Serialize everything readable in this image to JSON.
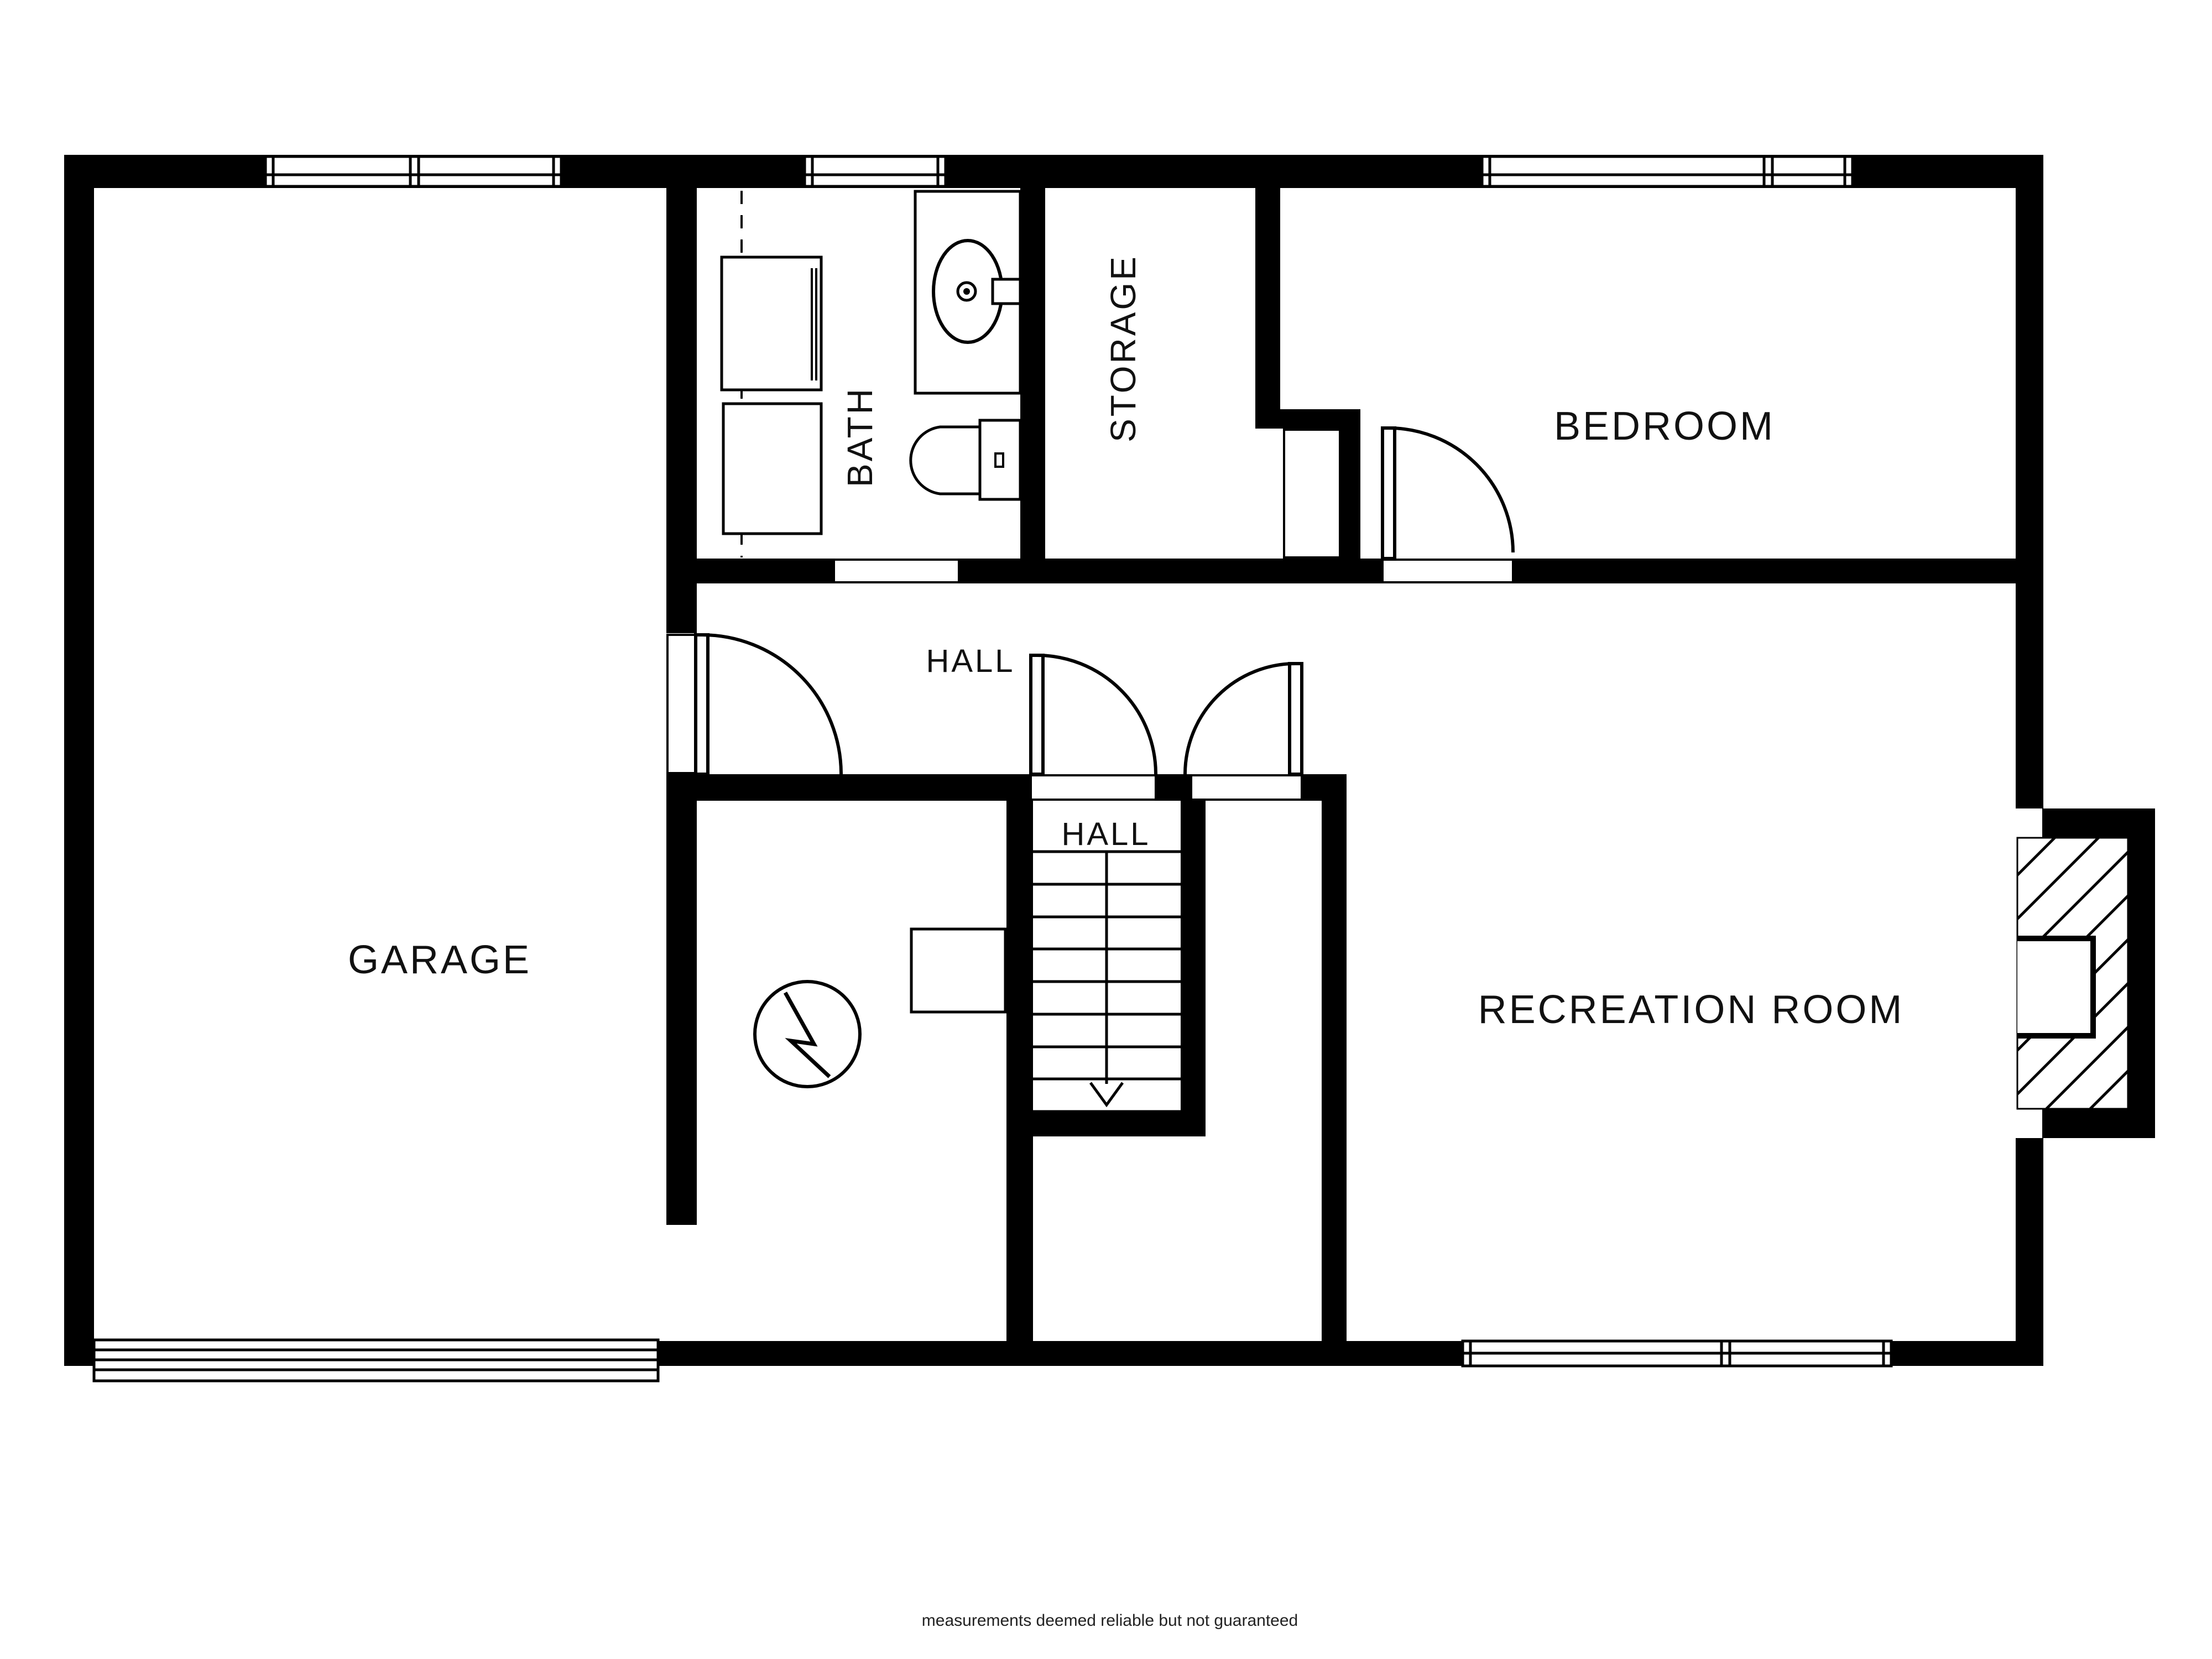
{
  "disclaimer": "measurements deemed reliable but not guaranteed",
  "colors": {
    "wall": "#000000",
    "background": "#ffffff",
    "label": "#111111"
  },
  "rooms": {
    "garage": {
      "label": "GARAGE"
    },
    "bath": {
      "label": "BATH",
      "orientation": "vertical"
    },
    "storage": {
      "label": "STORAGE",
      "orientation": "vertical"
    },
    "bedroom": {
      "label": "BEDROOM"
    },
    "hall_upper": {
      "label": "HALL"
    },
    "hall_lower": {
      "label": "HALL"
    },
    "recreation_room": {
      "label": "RECREATION ROOM"
    }
  },
  "fixtures": [
    {
      "name": "washer-icon"
    },
    {
      "name": "dryer-icon"
    },
    {
      "name": "bathroom-sink-icon"
    },
    {
      "name": "toilet-icon"
    },
    {
      "name": "water-heater-icon"
    },
    {
      "name": "fireplace-icon"
    },
    {
      "name": "staircase-down-icon"
    }
  ],
  "features": {
    "stairs": {
      "treads": 9,
      "direction": "down"
    },
    "windows": [
      {
        "room": "garage",
        "units": 2
      },
      {
        "room": "bath",
        "units": 1
      },
      {
        "room": "bedroom",
        "units": 2
      },
      {
        "room": "recreation_room",
        "units": 2
      }
    ],
    "doors": [
      {
        "from": "garage",
        "to": "hall"
      },
      {
        "from": "hall",
        "to": "stair-hall"
      },
      {
        "from": "hall",
        "to": "storage-corridor"
      },
      {
        "from": "bedroom",
        "to": "recreation_room"
      },
      {
        "from": "storage",
        "to": "bedroom"
      },
      {
        "from": "bath",
        "to": "hall",
        "type": "cased-opening"
      }
    ],
    "garage_door": {
      "panels": 1
    }
  }
}
